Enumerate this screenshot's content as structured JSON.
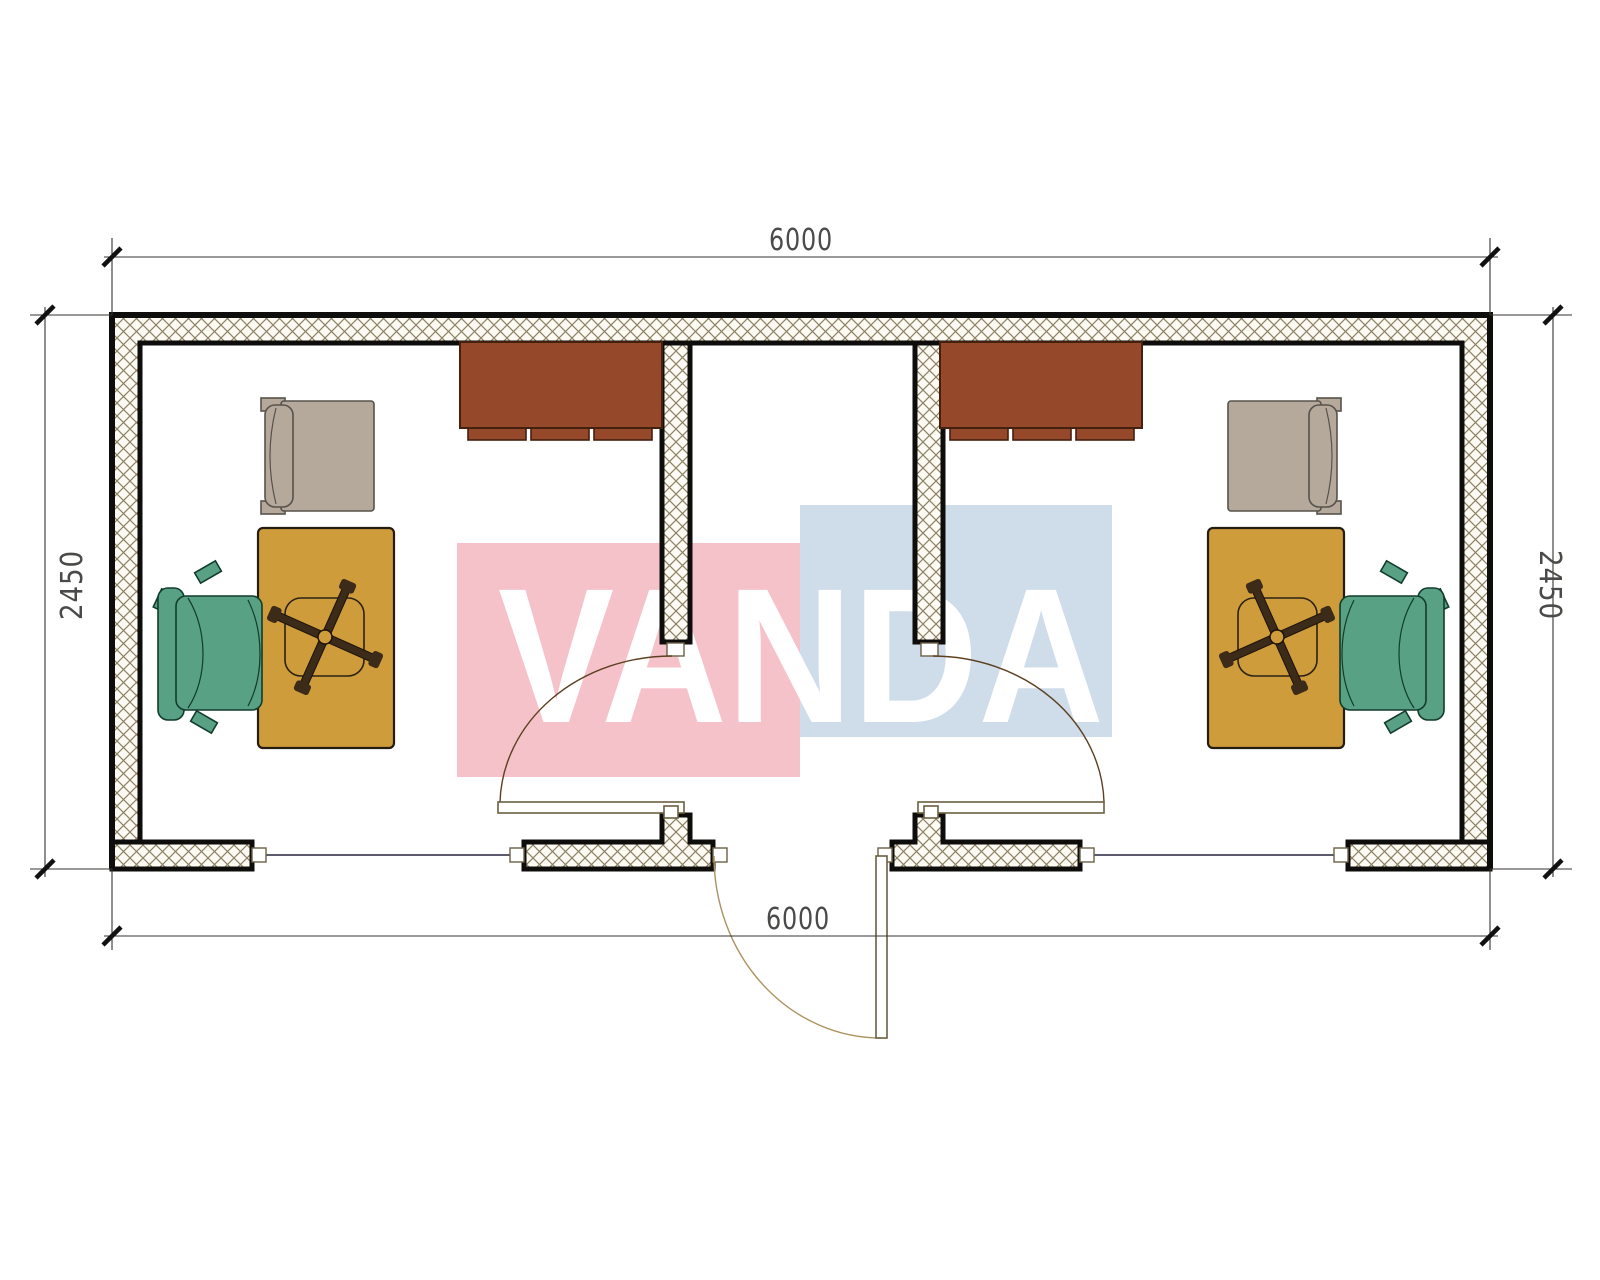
{
  "watermark": {
    "text": "VANDA",
    "red_color": "#f5c2ca",
    "blue_color": "#cfdcea",
    "text_color": "#ffffff"
  },
  "dimensions": {
    "top": "6000",
    "bottom": "6000",
    "left": "2450",
    "right": "2450"
  },
  "colors": {
    "wall_line": "#0e0d0b",
    "hatch_line": "#8d8164",
    "hatch_bg": "#fcfaf3",
    "window_line": "#23233c",
    "door_arc": "#5c4020",
    "entry_arc": "#ab9260",
    "dim_line": "#35332f",
    "dim_text": "#4a4a48",
    "cabinet_fill": "#96492a",
    "cabinet_outline": "#44200f",
    "desk_fill": "#cf9c3c",
    "desk_outline": "#241c0e",
    "chair_fill": "#58a184",
    "chair_outline": "#123c2b",
    "chair_base_fill": "#3b2b18",
    "armchair_fill": "#b5a99b",
    "armchair_outline": "#57524b"
  },
  "furniture": {
    "left_room": [
      "wardrobe-cabinet",
      "armchair",
      "desk",
      "office-chair"
    ],
    "right_room": [
      "wardrobe-cabinet",
      "armchair",
      "desk",
      "office-chair"
    ]
  }
}
